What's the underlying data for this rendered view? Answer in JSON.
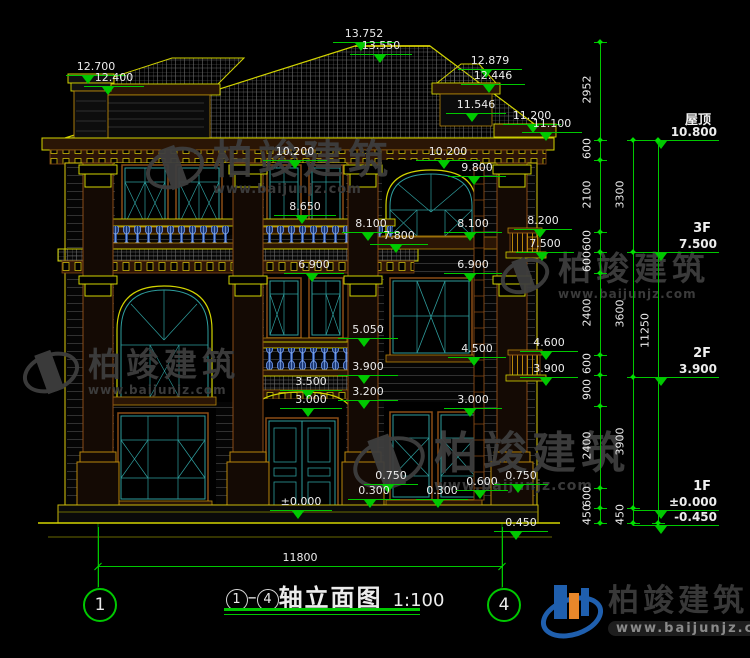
{
  "drawing_title": {
    "num1": "1",
    "num2": "4",
    "label": "轴立面图",
    "scale": "1:100"
  },
  "bottom_dimension": {
    "label": "11800"
  },
  "grid_bubbles": {
    "left": "1",
    "right": "4"
  },
  "watermark": {
    "text": "柏竣建筑",
    "url": "www.baijunjz.com"
  },
  "logo": {
    "name": "柏竣建筑",
    "url": "www.baijunjz.com"
  },
  "floor_markers": [
    {
      "name": "屋顶",
      "value": "10.800",
      "y": 140
    },
    {
      "name": "3F",
      "value": "7.500",
      "y": 252
    },
    {
      "name": "2F",
      "value": "3.900",
      "y": 377
    },
    {
      "name": "1F",
      "value": "±0.000",
      "y": 510
    },
    {
      "name": "",
      "value": "-0.450",
      "y": 525
    }
  ],
  "elevation_markers": [
    {
      "l": "13.752",
      "x": 333,
      "y": 42,
      "w": 62,
      "t": 22
    },
    {
      "l": "13.550",
      "x": 350,
      "y": 54,
      "w": 62,
      "t": 24
    },
    {
      "l": "12.700",
      "x": 66,
      "y": 75,
      "w": 60,
      "t": 16
    },
    {
      "l": "12.400",
      "x": 84,
      "y": 86,
      "w": 60,
      "t": 18
    },
    {
      "l": "12.879",
      "x": 458,
      "y": 69,
      "w": 64,
      "t": 22
    },
    {
      "l": "12.446",
      "x": 461,
      "y": 84,
      "w": 64,
      "t": 22
    },
    {
      "l": "11.546",
      "x": 446,
      "y": 113,
      "w": 60,
      "t": 20
    },
    {
      "l": "11.200",
      "x": 503,
      "y": 124,
      "w": 58,
      "t": 24
    },
    {
      "l": "11.100",
      "x": 522,
      "y": 132,
      "w": 60,
      "t": 18
    },
    {
      "l": "10.200",
      "x": 263,
      "y": 160,
      "w": 64,
      "t": 26
    },
    {
      "l": "10.200",
      "x": 416,
      "y": 160,
      "w": 64,
      "t": 22
    },
    {
      "l": "9.800",
      "x": 448,
      "y": 176,
      "w": 58,
      "t": 20
    },
    {
      "l": "8.650",
      "x": 274,
      "y": 215,
      "w": 62,
      "t": 22
    },
    {
      "l": "8.200",
      "x": 514,
      "y": 229,
      "w": 58,
      "t": 20
    },
    {
      "l": "8.100",
      "x": 342,
      "y": 232,
      "w": 58,
      "t": 20
    },
    {
      "l": "8.100",
      "x": 444,
      "y": 232,
      "w": 58,
      "t": 20
    },
    {
      "l": "7.800",
      "x": 370,
      "y": 244,
      "w": 58,
      "t": 20
    },
    {
      "l": "7.500",
      "x": 516,
      "y": 252,
      "w": 58,
      "t": 20
    },
    {
      "l": "6.900",
      "x": 284,
      "y": 273,
      "w": 60,
      "t": 22
    },
    {
      "l": "6.900",
      "x": 444,
      "y": 273,
      "w": 58,
      "t": 20
    },
    {
      "l": "5.050",
      "x": 338,
      "y": 338,
      "w": 60,
      "t": 20
    },
    {
      "l": "4.600",
      "x": 520,
      "y": 351,
      "w": 58,
      "t": 20
    },
    {
      "l": "4.500",
      "x": 448,
      "y": 357,
      "w": 58,
      "t": 20
    },
    {
      "l": "3.900",
      "x": 338,
      "y": 375,
      "w": 60,
      "t": 20
    },
    {
      "l": "3.900",
      "x": 520,
      "y": 377,
      "w": 58,
      "t": 20
    },
    {
      "l": "3.500",
      "x": 280,
      "y": 390,
      "w": 62,
      "t": 22
    },
    {
      "l": "3.200",
      "x": 338,
      "y": 400,
      "w": 60,
      "t": 20
    },
    {
      "l": "3.000",
      "x": 280,
      "y": 408,
      "w": 62,
      "t": 22
    },
    {
      "l": "3.000",
      "x": 444,
      "y": 408,
      "w": 58,
      "t": 20
    },
    {
      "l": "0.750",
      "x": 364,
      "y": 484,
      "w": 54,
      "t": 18
    },
    {
      "l": "0.300",
      "x": 348,
      "y": 499,
      "w": 52,
      "t": 16
    },
    {
      "l": "0.300",
      "x": 416,
      "y": 499,
      "w": 52,
      "t": 16
    },
    {
      "l": "0.600",
      "x": 456,
      "y": 490,
      "w": 52,
      "t": 18
    },
    {
      "l": "0.750",
      "x": 494,
      "y": 484,
      "w": 54,
      "t": 18
    },
    {
      "l": "±0.000",
      "x": 270,
      "y": 510,
      "w": 62,
      "t": 22
    },
    {
      "l": "0.450",
      "x": 494,
      "y": 531,
      "w": 54,
      "t": 16
    }
  ],
  "chains": [
    {
      "x": 600,
      "y1": 42,
      "y2": 523,
      "ticks": [
        42,
        140,
        160,
        232,
        252,
        273,
        355,
        375,
        406,
        488,
        508,
        523
      ],
      "labels": [
        {
          "t": "2952",
          "y": 91
        },
        {
          "t": "600",
          "y": 150
        },
        {
          "t": "2100",
          "y": 196
        },
        {
          "t": "600",
          "y": 242
        },
        {
          "t": "600",
          "y": 263
        },
        {
          "t": "2400",
          "y": 314
        },
        {
          "t": "600",
          "y": 365
        },
        {
          "t": "900",
          "y": 391
        },
        {
          "t": "2400",
          "y": 447
        },
        {
          "t": "600",
          "y": 498
        },
        {
          "t": "450",
          "y": 516
        }
      ]
    },
    {
      "x": 633,
      "y1": 140,
      "y2": 523,
      "ticks": [
        140,
        252,
        377,
        508,
        523
      ],
      "labels": [
        {
          "t": "3300",
          "y": 196
        },
        {
          "t": "3600",
          "y": 315
        },
        {
          "t": "3900",
          "y": 443
        },
        {
          "t": "450",
          "y": 516
        }
      ]
    },
    {
      "x": 658,
      "y1": 140,
      "y2": 523,
      "ticks": [
        140,
        523
      ],
      "labels": [
        {
          "t": "11250",
          "y": 332
        }
      ]
    }
  ],
  "watermarks_pos": [
    {
      "x": 145,
      "y": 140,
      "is": 52,
      "fs": 40,
      "ufs": 13
    },
    {
      "x": 500,
      "y": 252,
      "is": 42,
      "fs": 33,
      "ufs": 12
    },
    {
      "x": 22,
      "y": 348,
      "is": 50,
      "fs": 33,
      "ufs": 12
    },
    {
      "x": 352,
      "y": 432,
      "is": 66,
      "fs": 44,
      "ufs": 14
    }
  ]
}
